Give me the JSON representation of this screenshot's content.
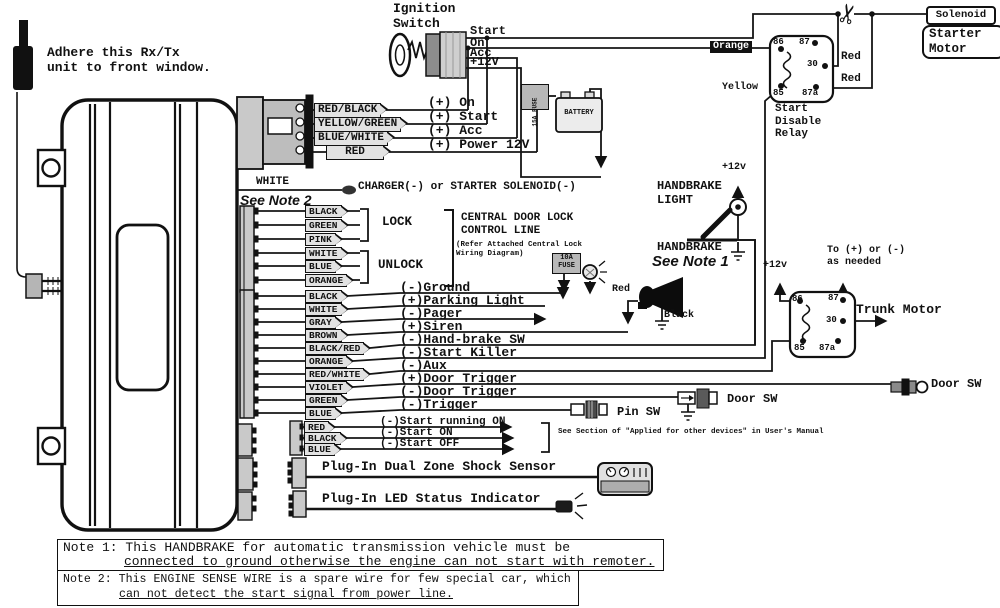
{
  "rx_unit": {
    "note": "Adhere this Rx/Tx\nunit to front window."
  },
  "ignition": {
    "label": "Ignition\nSwitch",
    "positions": [
      "Start",
      "On",
      "Acc",
      "+12V"
    ]
  },
  "power": {
    "wires": [
      {
        "wire": "RED/BLACK",
        "fn": "(+) On"
      },
      {
        "wire": "YELLOW/GREEN",
        "fn": "(+) Start"
      },
      {
        "wire": "BLUE/WHITE",
        "fn": "(+) Acc"
      },
      {
        "wire": "RED",
        "fn": "(+) Power 12V"
      }
    ],
    "fuse": "15A FUSE",
    "battery": "BATTERY"
  },
  "engine_sense": {
    "wire": "WHITE",
    "see": "See Note 2",
    "fn": "CHARGER(-) or STARTER SOLENOID(-)"
  },
  "door_lock": {
    "wires": [
      "BLACK",
      "GREEN",
      "PINK",
      "WHITE",
      "BLUE",
      "ORANGE"
    ],
    "lock": "LOCK",
    "unlock": "UNLOCK",
    "heading": "CENTRAL DOOR LOCK\nCONTROL LINE",
    "sub": "(Refer Attached Central Lock\nWiring Diagram)",
    "fuse": "10A\nFUSE"
  },
  "harness": {
    "wires": [
      {
        "wire": "BLACK",
        "fn": "(-)Ground"
      },
      {
        "wire": "WHITE",
        "fn": "(+)Parking Light"
      },
      {
        "wire": "GRAY",
        "fn": "(-)Pager"
      },
      {
        "wire": "BROWN",
        "fn": "(+)Siren"
      },
      {
        "wire": "BLACK/RED",
        "fn": "(-)Hand-brake SW"
      },
      {
        "wire": "ORANGE",
        "fn": "(-)Start Killer"
      },
      {
        "wire": "RED/WHITE",
        "fn": "(-)Aux"
      },
      {
        "wire": "VIOLET",
        "fn": "(+)Door Trigger"
      },
      {
        "wire": "GREEN",
        "fn": "(-)Door Trigger"
      },
      {
        "wire": "BLUE",
        "fn": "(-)Trigger"
      }
    ]
  },
  "start_group": {
    "wires": [
      {
        "wire": "RED",
        "fn": "(-)Start running ON"
      },
      {
        "wire": "BLACK",
        "fn": "(-)Start ON"
      },
      {
        "wire": "BLUE",
        "fn": "(-)Start OFF"
      }
    ],
    "note": "See Section of \"Applied for other devices\" in User's Manual"
  },
  "plugins": {
    "shock": "Plug-In Dual Zone Shock Sensor",
    "led": "Plug-In LED Status Indicator"
  },
  "handbrake": {
    "v12": "+12v",
    "light": "HANDBRAKE\nLIGHT",
    "name": "HANDBRAKE",
    "see": "See Note 1"
  },
  "siren": {
    "red": "Red",
    "black": "Black"
  },
  "start_relay": {
    "p86": "86",
    "p87": "87",
    "p30": "30",
    "p85": "85",
    "p87a": "87a",
    "orange": "Orange",
    "yellow": "Yellow",
    "red_top": "Red",
    "red_bottom": "Red",
    "name": "Start\nDisable\nRelay",
    "solenoid": "Solenoid",
    "starter": "Starter\nMotor"
  },
  "trunk_relay": {
    "p86": "86",
    "p87": "87",
    "p30": "30",
    "p85": "85",
    "p87a": "87a",
    "v12": "+12v",
    "to": "To (+) or (-)\nas needed",
    "motor": "Trunk Motor"
  },
  "switches": {
    "door_right": "Door SW",
    "door_mid": "Door SW",
    "pin": "Pin SW"
  },
  "notes": {
    "n1a": "Note 1: This HANDBRAKE for automatic transmission vehicle must be",
    "n1b": "connected to ground otherwise the engine can not start with remoter.",
    "n2a": "Note 2: This ENGINE SENSE WIRE is a spare wire for few special car, which",
    "n2b": "can not detect the start signal from power line."
  },
  "colors": {
    "ink": "#111111",
    "paper": "#ffffff",
    "label_bg": "#e2e2e2",
    "connector": "#c9c9c9"
  }
}
